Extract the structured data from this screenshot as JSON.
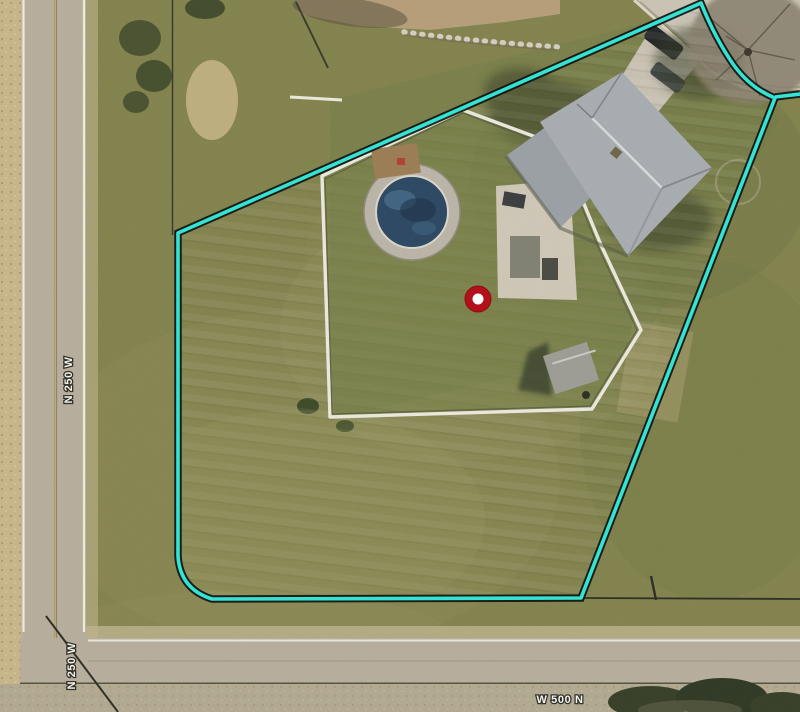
{
  "scene": {
    "title": "aerial-parcel-map-view",
    "labels": {
      "road_vertical_upper": "N 250 W",
      "road_vertical_lower": "N 250 W",
      "road_horizontal": "W 500 N"
    },
    "marker": {
      "x": 478,
      "y": 299,
      "outer_radius": 13,
      "inner_radius": 5.5,
      "outer_color": "#b2111b",
      "inner_color": "#ffffff"
    },
    "parcel": {
      "path": "M178,233 L178,556 Q180,589 212,599 L581,598 L775,98 Q750,88 733,64 Q715,38 701,3 Z",
      "spur_path": "M775,97 L800,94",
      "stroke_color": "#35e3d4",
      "casing_color": "#101210",
      "stroke_width": 3.6
    },
    "colors": {
      "grass_base": "#81814e",
      "dirt_field": "#c6b488",
      "road_surface": "#b5ac9b",
      "concrete": "#c8c2b3",
      "roof": "#a6abaf"
    }
  }
}
